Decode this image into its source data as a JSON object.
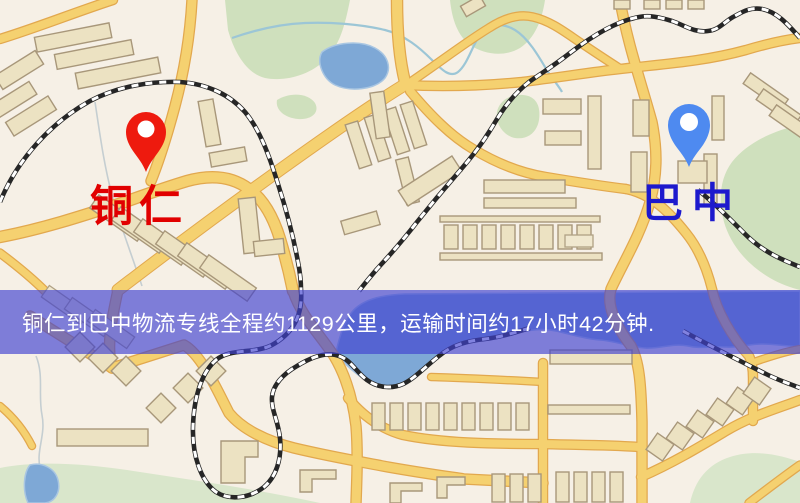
{
  "banner": {
    "text": "铜仁到巴中物流专线全程约1129公里，运输时间约17小时42分钟.",
    "overlay_color": "#4042d0",
    "overlay_opacity": "0.66",
    "text_color": "#ffffff"
  },
  "markers": {
    "origin": {
      "label": "铜仁",
      "pin_color": "#ee1a0e",
      "label_color": "#e10000"
    },
    "destination": {
      "label": "巴中",
      "pin_color": "#4e8af0",
      "label_color": "#1d19cd"
    }
  },
  "map": {
    "palette": {
      "background": "#f6f0e6",
      "road_fill": "#f5d170",
      "road_casing": "#e2a84e",
      "building_fill": "#ece2c2",
      "building_stroke": "#a8977a",
      "green_area": "#cfe0bd",
      "water": "#7ea8d6",
      "railway": "#262626"
    }
  }
}
